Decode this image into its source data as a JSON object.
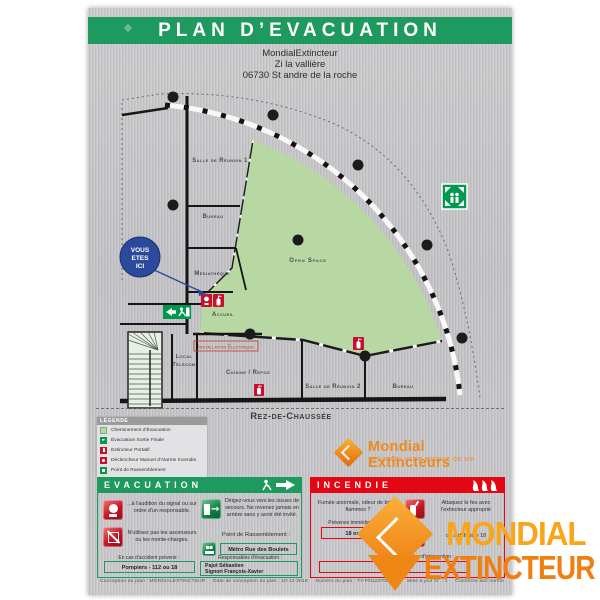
{
  "poster": {
    "title": "PLAN D’EVACUATION",
    "address_line1": "MondialExtincteur",
    "address_line2": "Zi la vallière",
    "address_line3": "06730 St andre de la roche",
    "floor_label": "Rez-de-Chaussée",
    "footer": "Conception du plan : MONDIALEXTINCTEUR     Date de conception du plan : 10-12-2016     Numéro du plan : TY-PN123700-101     Mise à jour N° : 1     Conforme aux normes : NF X08-070 & ISO 3864-1 & ISO 3864-3"
  },
  "plan": {
    "you_are_here_line1": "VOUS",
    "you_are_here_line2": "ETES",
    "you_are_here_line3": "ICI",
    "rooms": {
      "salle_reunion_1": "Salle de Réunion 1",
      "bureau_1": "Bureau",
      "mediatheque": "Médiathèque",
      "accueil": "Accueil",
      "open_space": "Open Space",
      "local_telecom_line1": "Local",
      "local_telecom_line2": "Télécom",
      "installation_electrique": "Installation Électrique",
      "cuisine_repos": "Cuisine / Repos",
      "salle_reunion_2": "Salle de Réunion 2",
      "bureau_2": "Bureau"
    }
  },
  "legend": {
    "header": "Légende",
    "items": [
      "Cheminement d'Évacuation",
      "Évacuation Sortie Finale",
      "Extincteur Portatif",
      "Déclencheur Manuel d'Alarme Incendie",
      "Point de Rassemblement"
    ]
  },
  "brand": {
    "name": "Mondial Extincteurs",
    "tagline": "sécuriser votre espace de vie"
  },
  "evacuation": {
    "header": "EVACUATION",
    "signal_text": "...à l'audition du signal ou sur ordre d'un responsable.",
    "exits_text": "Dirigez-vous vers les issues de secours. Ne revenez jamais en arrière sans y avoir été invité.",
    "elevator_text": "N'utilisez pas les ascenseurs ou les monte-charges.",
    "assembly_label": "Point de Rassemblement :",
    "assembly_value": "Métro Rue des Boulets",
    "accident_label": "En cas d'accident prévenir :",
    "accident_value": "Pompiers - 112 ou 18",
    "responsible_label": "Responsables d'évacuation :",
    "responsible_name1": "Pajot Sébastien",
    "responsible_name2": "Signori François-Xavier"
  },
  "incendie": {
    "header": "INCENDIE",
    "alert_text": "Fumée anormale, odeur de brûlé, flammes ?",
    "notify_label": "Prévenez immédiatement :",
    "notify_value": "18 ou 112",
    "attack_text": "Attaquez le feu avec l'extincteur approprié",
    "fallback_text": "ou à défaut le 18",
    "responsible_label": "Responsables d'intervention :",
    "responsible_value": ""
  },
  "watermark": {
    "line1": "MONDIAL",
    "line2": "EXTINCTEUR"
  },
  "colors": {
    "header_green": "#1f9a5e",
    "fire_red": "#e30613",
    "evacuation_path_green": "#b7d7a3",
    "brand_orange": "#f9a51a",
    "you_are_here_blue": "#2b4a9c"
  }
}
